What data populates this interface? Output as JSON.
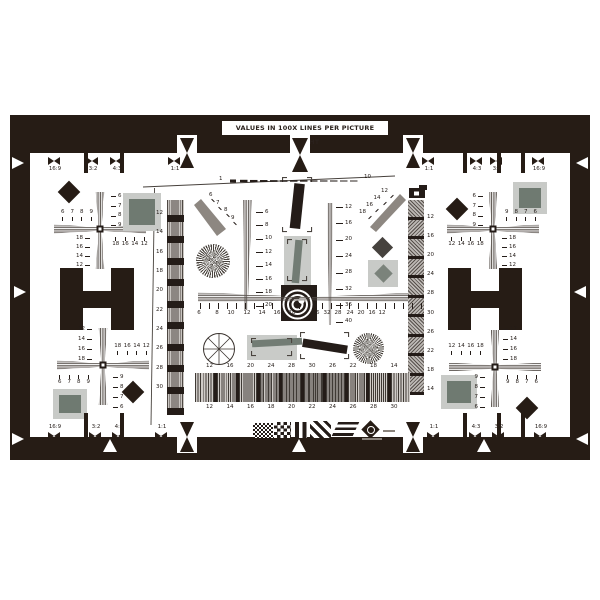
{
  "title": "VALUES IN 100X LINES PER PICTURE HEIGHT",
  "scale_line": {
    "start": "1",
    "end": "10"
  },
  "aspect": {
    "top_left": [
      "16:9",
      "3:2",
      "4:3",
      "1:1"
    ],
    "top_right": [
      "1:1",
      "4:3",
      "3:2",
      "16:9"
    ],
    "bottom_left": [
      "16:9",
      "3:2",
      "4:3",
      "1:1"
    ],
    "bottom_right": [
      "1:1",
      "4:3",
      "3:2",
      "16:9"
    ]
  },
  "left_strip_labels": [
    "12",
    "14",
    "16",
    "18",
    "20",
    "22",
    "24",
    "26",
    "28",
    "30"
  ],
  "right_strip_labels": [
    "12",
    "16",
    "20",
    "24",
    "28",
    "30",
    "26",
    "22",
    "18",
    "14"
  ],
  "center": {
    "left_wedge": [
      "6",
      "8",
      "10",
      "12",
      "14",
      "16",
      "18",
      "20"
    ],
    "right_wedge": [
      "12",
      "16",
      "20",
      "24",
      "28",
      "32",
      "36",
      "40"
    ],
    "diag_left": [
      "6",
      "7",
      "8",
      "9"
    ],
    "diag_right": [
      "18",
      "16",
      "14",
      "12"
    ],
    "hruler_left": [
      "6",
      "8",
      "10",
      "12",
      "14",
      "16",
      "18"
    ],
    "hruler_right": [
      "36",
      "32",
      "28",
      "24",
      "20",
      "16",
      "12"
    ]
  },
  "bottom_strip": {
    "top": [
      "12",
      "16",
      "20",
      "24",
      "28",
      "30",
      "26",
      "22",
      "18",
      "14"
    ],
    "bottom": [
      "12",
      "14",
      "16",
      "18",
      "20",
      "22",
      "24",
      "26",
      "28",
      "30"
    ]
  },
  "crosses": {
    "tl": {
      "outer_h": [
        "6",
        "7",
        "8",
        "9"
      ],
      "outer_v": [
        "6",
        "7",
        "8",
        "9"
      ],
      "inner_v": [
        "18",
        "16",
        "14",
        "12"
      ],
      "inner_h": [
        "18",
        "16",
        "14",
        "12"
      ]
    },
    "tr": {
      "outer_h": [
        "9",
        "8",
        "7",
        "6"
      ],
      "outer_v": [
        "6",
        "7",
        "8",
        "9"
      ],
      "inner_v": [
        "18",
        "16",
        "14",
        "12"
      ],
      "inner_h": [
        "12",
        "14",
        "16",
        "18"
      ]
    },
    "bl": {
      "outer_h": [
        "6",
        "7",
        "8",
        "9"
      ],
      "outer_v": [
        "9",
        "8",
        "7",
        "6"
      ],
      "inner_v": [
        "12",
        "14",
        "16",
        "18"
      ],
      "inner_h": [
        "18",
        "16",
        "14",
        "12"
      ]
    },
    "br": {
      "outer_h": [
        "9",
        "8",
        "7",
        "6"
      ],
      "outer_v": [
        "9",
        "8",
        "7",
        "6"
      ],
      "inner_v": [
        "12",
        "14",
        "16",
        "18"
      ],
      "inner_h": [
        "12",
        "14",
        "16",
        "18"
      ]
    }
  },
  "colors": {
    "frame_black": "#261c15",
    "patch_inner_gray": "#6f7a71",
    "patch_outer_gray": "#c8cac7",
    "bar_gray": "#737d75",
    "wedge_gray": "#8d8781",
    "text": "#241c18"
  }
}
